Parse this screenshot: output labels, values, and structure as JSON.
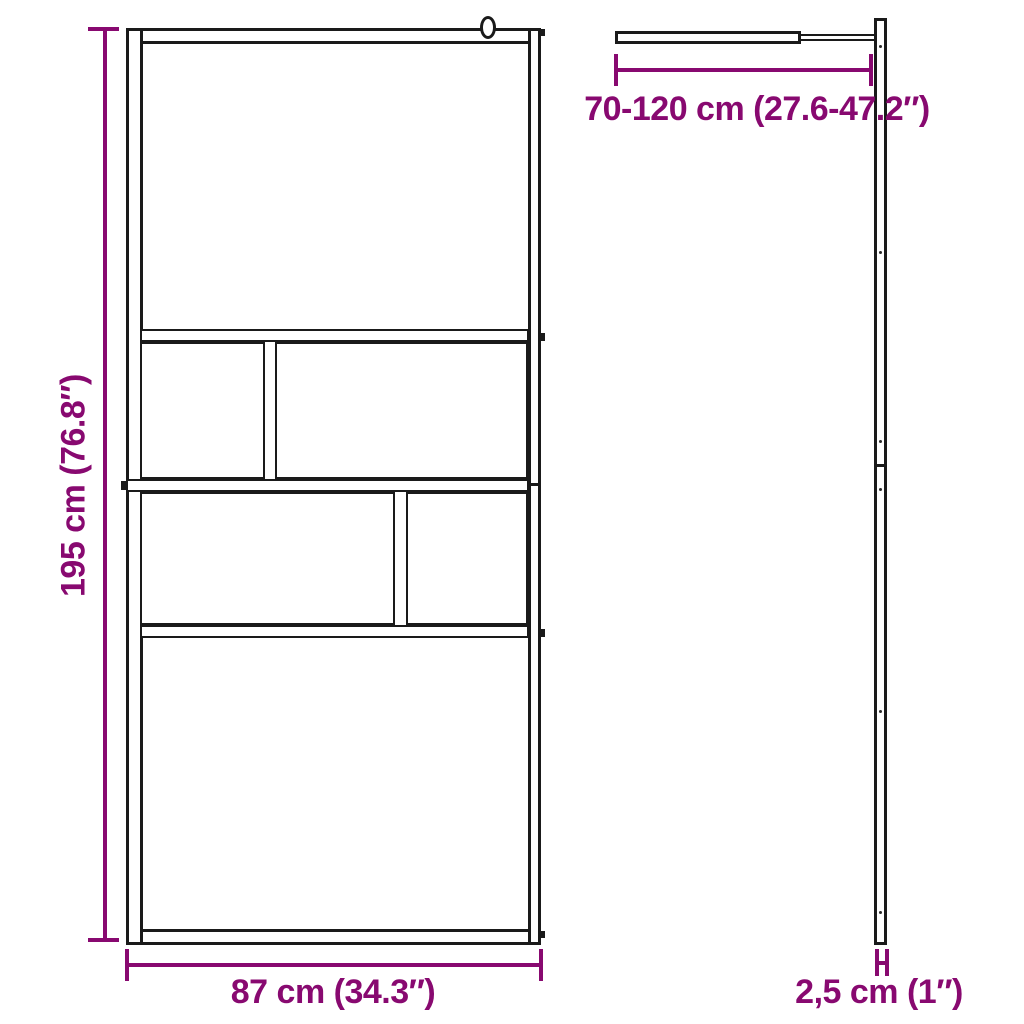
{
  "measurements": {
    "height": {
      "cm": "195",
      "inches": "76.8",
      "label": "195 cm (76.8″)"
    },
    "width": {
      "cm": "87",
      "inches": "34.3",
      "label": "87 cm (34.3″)"
    },
    "arm_length": {
      "cm": "70-120",
      "inches": "27.6-47.2",
      "label": "70-120 cm (27.6-47.2″)"
    },
    "thickness": {
      "cm": "2,5",
      "inches": "1",
      "label": "2,5 cm (1″)"
    }
  },
  "colors": {
    "dimension_purple": "#880970",
    "line_black": "#1a1a1a",
    "background": "#ffffff"
  }
}
